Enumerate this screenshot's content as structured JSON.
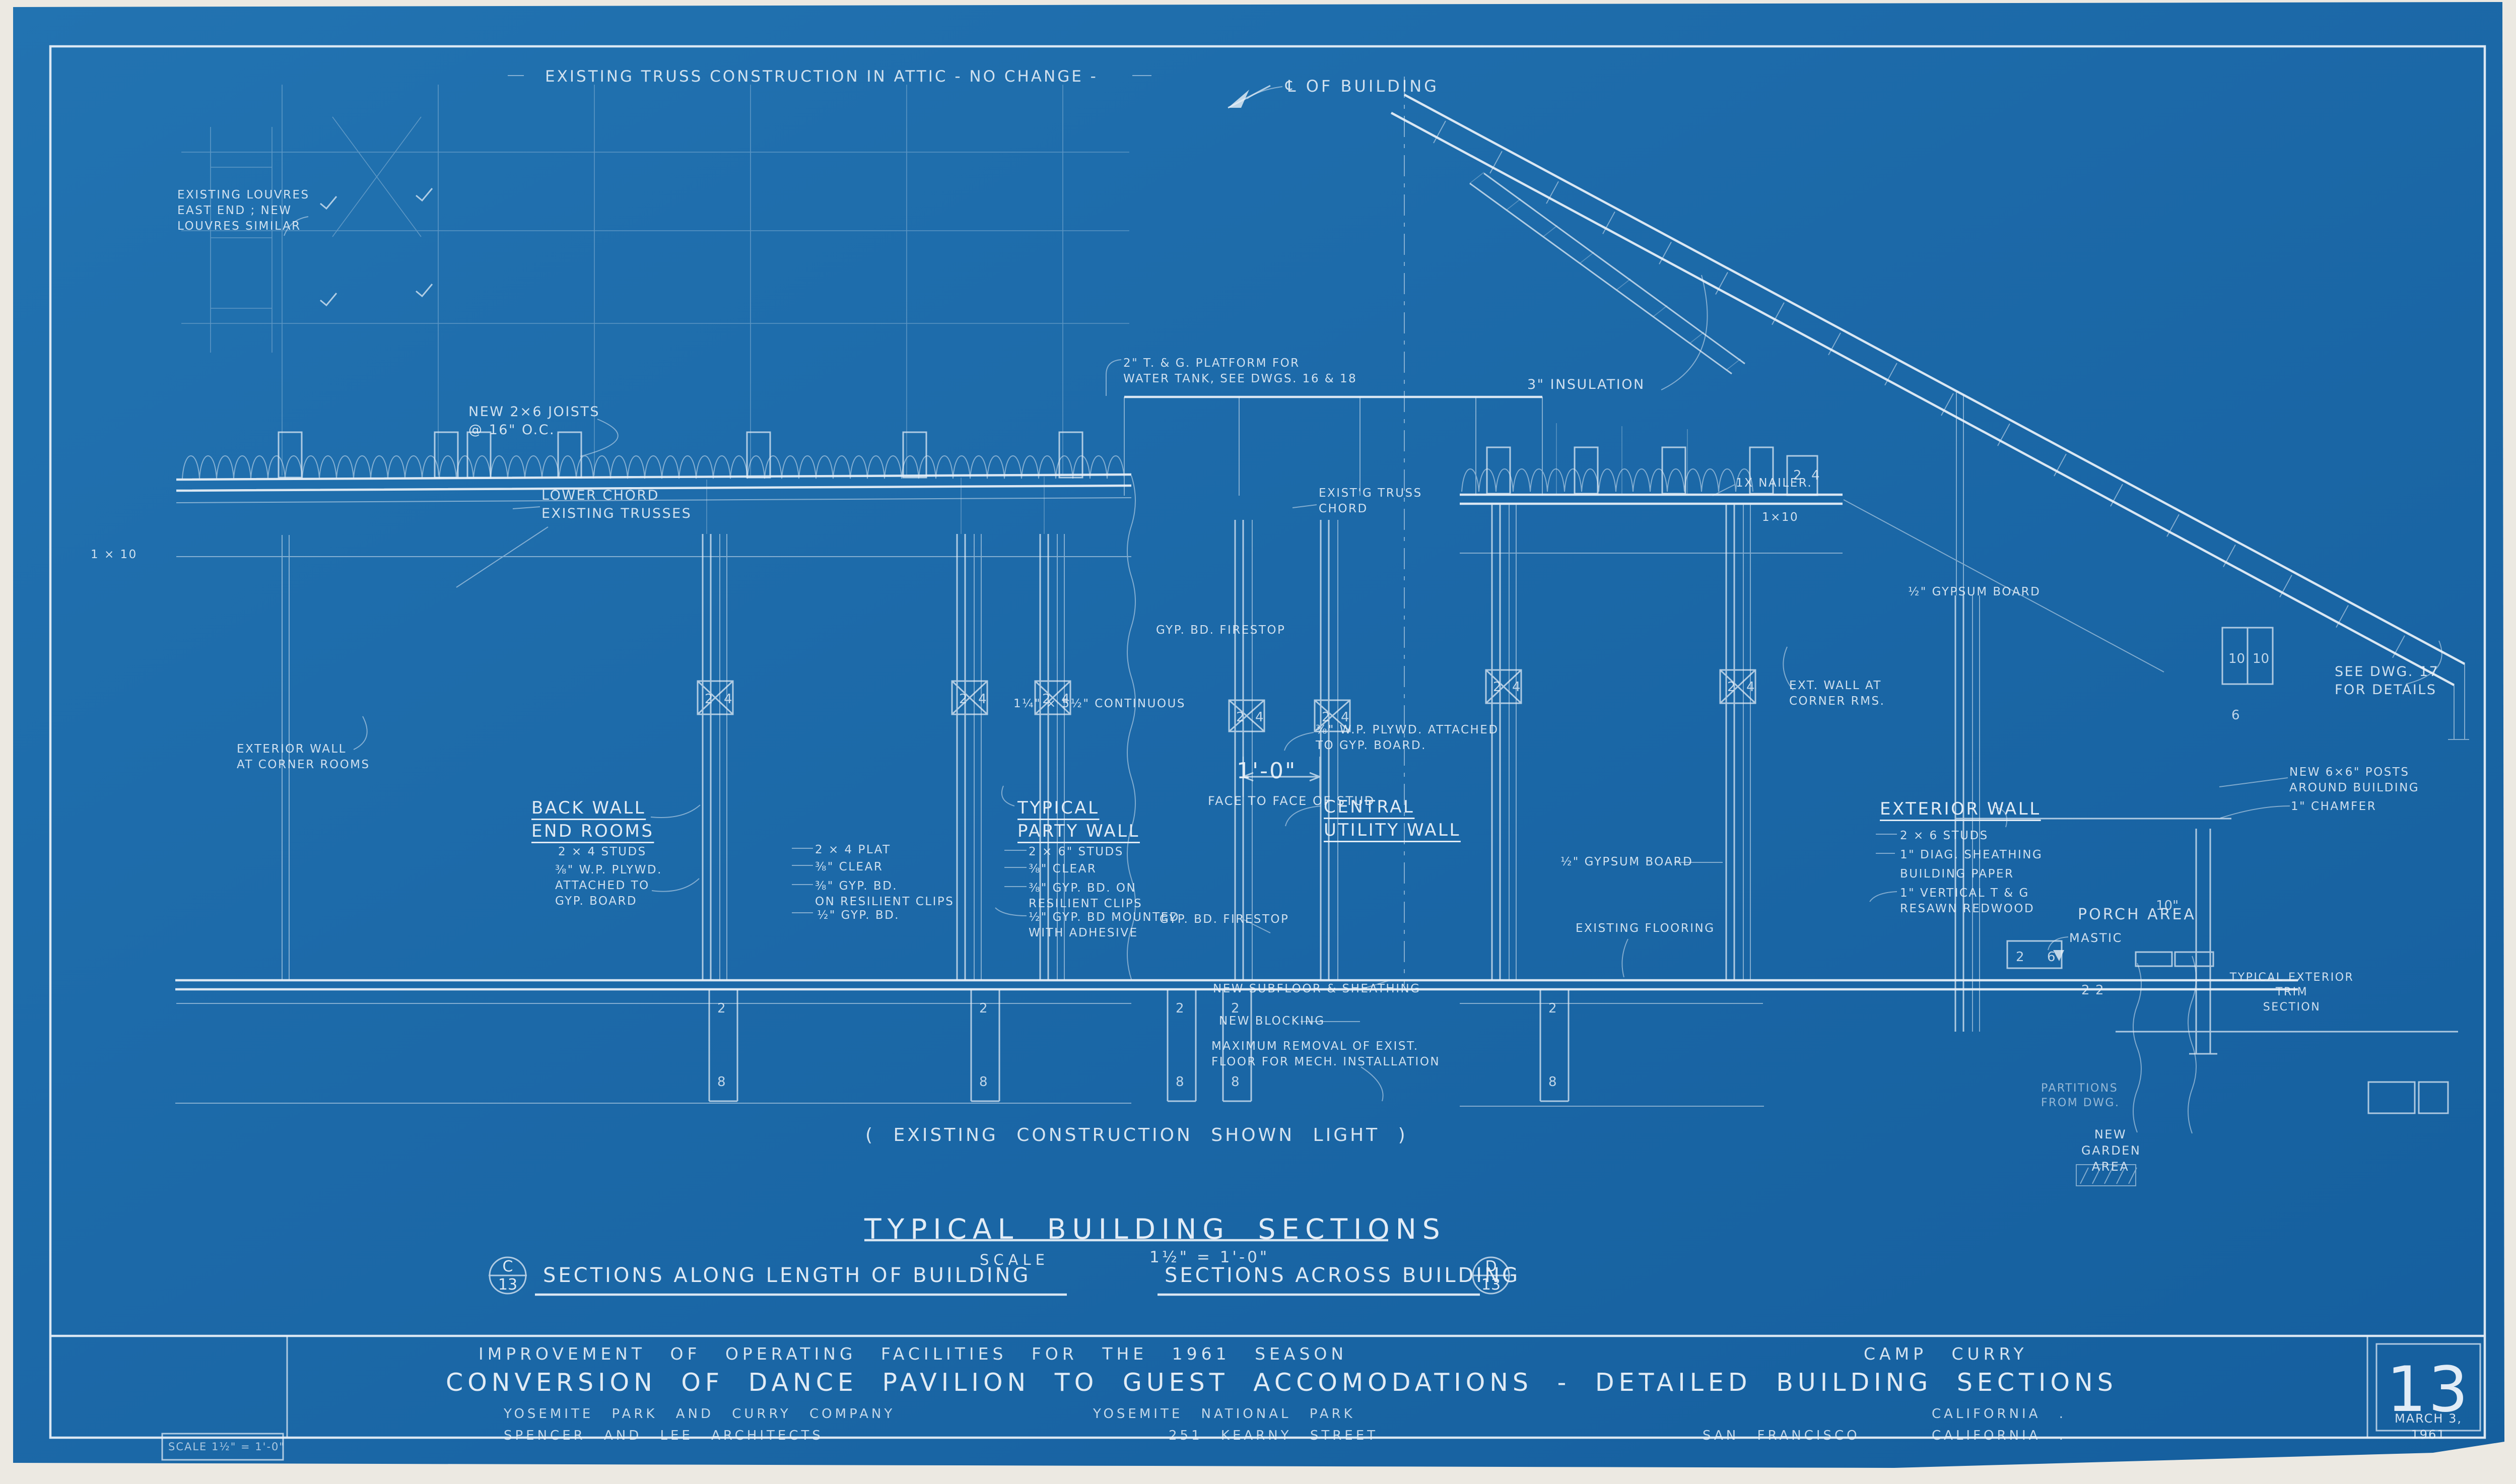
{
  "colors": {
    "paper": "#ece9e2",
    "sheet_blue": "#1c69a8",
    "line_white": "#e9f1f9"
  },
  "top": {
    "attic_note": "EXISTING TRUSS CONSTRUCTION IN ATTIC - NO CHANGE -",
    "centerline_label": "℄ OF BUILDING"
  },
  "left": {
    "louvres": "EXISTING LOUVRES\nEAST END ; NEW\nLOUVRES SIMILAR",
    "joists": "NEW 2×6 JOISTS\n@ 16\" O.C.",
    "lower_chord": "LOWER CHORD\nEXISTING TRUSSES",
    "one_by_ten": "1 × 10",
    "ext_wall_corner": "EXTERIOR WALL\nAT CORNER ROOMS",
    "back_wall_heading": "BACK WALL\nEND ROOMS",
    "back_wall_note1": "2 × 4 STUDS",
    "back_wall_note2": "⅜\" W.P. PLYWD.\nATTACHED TO\nGYP. BOARD",
    "mid_note1": "2 × 4 PLAT",
    "mid_note2": "⅜\" CLEAR",
    "mid_note3": "⅜\" GYP. BD.\nON RESILIENT CLIPS",
    "mid_note4": "½\" GYP. BD.",
    "party_heading": "TYPICAL\nPARTY WALL",
    "party_note1": "2 × 6\" STUDS",
    "party_note2": "⅜\" CLEAR",
    "party_note3": "⅜\" GYP. BD. ON\nRESILIENT CLIPS",
    "party_note4": "½\" GYP. BD MOUNTED\nWITH ADHESIVE",
    "continuous": "1¼\" × 5½\" CONTINUOUS",
    "firestop_upper": "GYP. BD. FIRESTOP"
  },
  "center": {
    "platform": "2\" T. & G. PLATFORM FOR\nWATER TANK, SEE DWGS. 16 & 18",
    "insulation": "3\" INSULATION",
    "truss_chord": "EXIST'G TRUSS\nCHORD",
    "nailer": "1X NAILER.",
    "one_by_ten": "1×10",
    "dim": "1'-0\"",
    "dim_caption": "FACE TO FACE OF STUD",
    "plywd": "⅜\" W.P. PLYWD. ATTACHED\nTO GYP. BOARD.",
    "utility_heading": "CENTRAL\nUTILITY WALL",
    "gypsum": "½\" GYPSUM BOARD",
    "flooring": "EXISTING FLOORING",
    "firestop_lower": "GYP. BD. FIRESTOP",
    "subfloor": "NEW SUBFLOOR & SHEATHING",
    "blocking": "NEW BLOCKING",
    "removal": "MAXIMUM REMOVAL OF EXIST.\nFLOOR FOR MECH. INSTALLATION"
  },
  "right": {
    "gypsum": "½\" GYPSUM BOARD",
    "corner_rms": "EXT. WALL AT\nCORNER RMS.",
    "exterior_heading": "EXTERIOR WALL",
    "ext_note1": "2 × 6 STUDS",
    "ext_note2": "1\" DIAG. SHEATHING",
    "ext_note3": "BUILDING PAPER",
    "ext_note4": "1\" VERTICAL T & G\nRESAWN REDWOOD",
    "see_dwg": "SEE DWG. 17\nFOR DETAILS",
    "posts": "NEW 6×6\" POSTS\nAROUND BUILDING",
    "chamfer": "1\" CHAMFER",
    "porch": "PORCH AREA",
    "mastic": "MASTIC",
    "trim": "TYPICAL EXTERIOR TRIM\nSECTION",
    "partitions": "PARTITIONS\nFROM DWG.",
    "garden": "NEW\nGARDEN\nAREA"
  },
  "footer": {
    "existing_note": "( EXISTING CONSTRUCTION SHOWN LIGHT )",
    "title": "TYPICAL BUILDING SECTIONS",
    "scale_label": "SCALE",
    "scale_value": "1½\" = 1'-0\"",
    "caption_left": "SECTIONS ALONG LENGTH OF BUILDING",
    "caption_right": "SECTIONS ACROSS BUILDING",
    "marker_left": {
      "letter": "C",
      "number": "13"
    },
    "marker_right": {
      "letter": "D",
      "number": "13"
    }
  },
  "title_block": {
    "row1_left": "IMPROVEMENT OF OPERATING FACILITIES FOR THE 1961 SEASON",
    "row1_right": "CAMP CURRY",
    "row2": "CONVERSION OF DANCE PAVILION TO GUEST ACCOMODATIONS - DETAILED BUILDING SECTIONS",
    "row3_company": "YOSEMITE PARK AND CURRY COMPANY",
    "row3_park": "YOSEMITE NATIONAL PARK",
    "row3_state": "CALIFORNIA .",
    "row4_architects": "SPENCER AND LEE ARCHITECTS",
    "row4_street": "251 KEARNY STREET",
    "row4_city": "SAN FRANCISCO",
    "row4_state": "CALIFORNIA .",
    "scale_box": "SCALE 1½\" = 1'-0\"",
    "sheet_number": "13",
    "date": "MARCH 3, 1961"
  },
  "figures": {
    "two": "2",
    "four": "4",
    "six": "6",
    "eight": "8",
    "ten": "10",
    "ten_inch": "10\""
  }
}
